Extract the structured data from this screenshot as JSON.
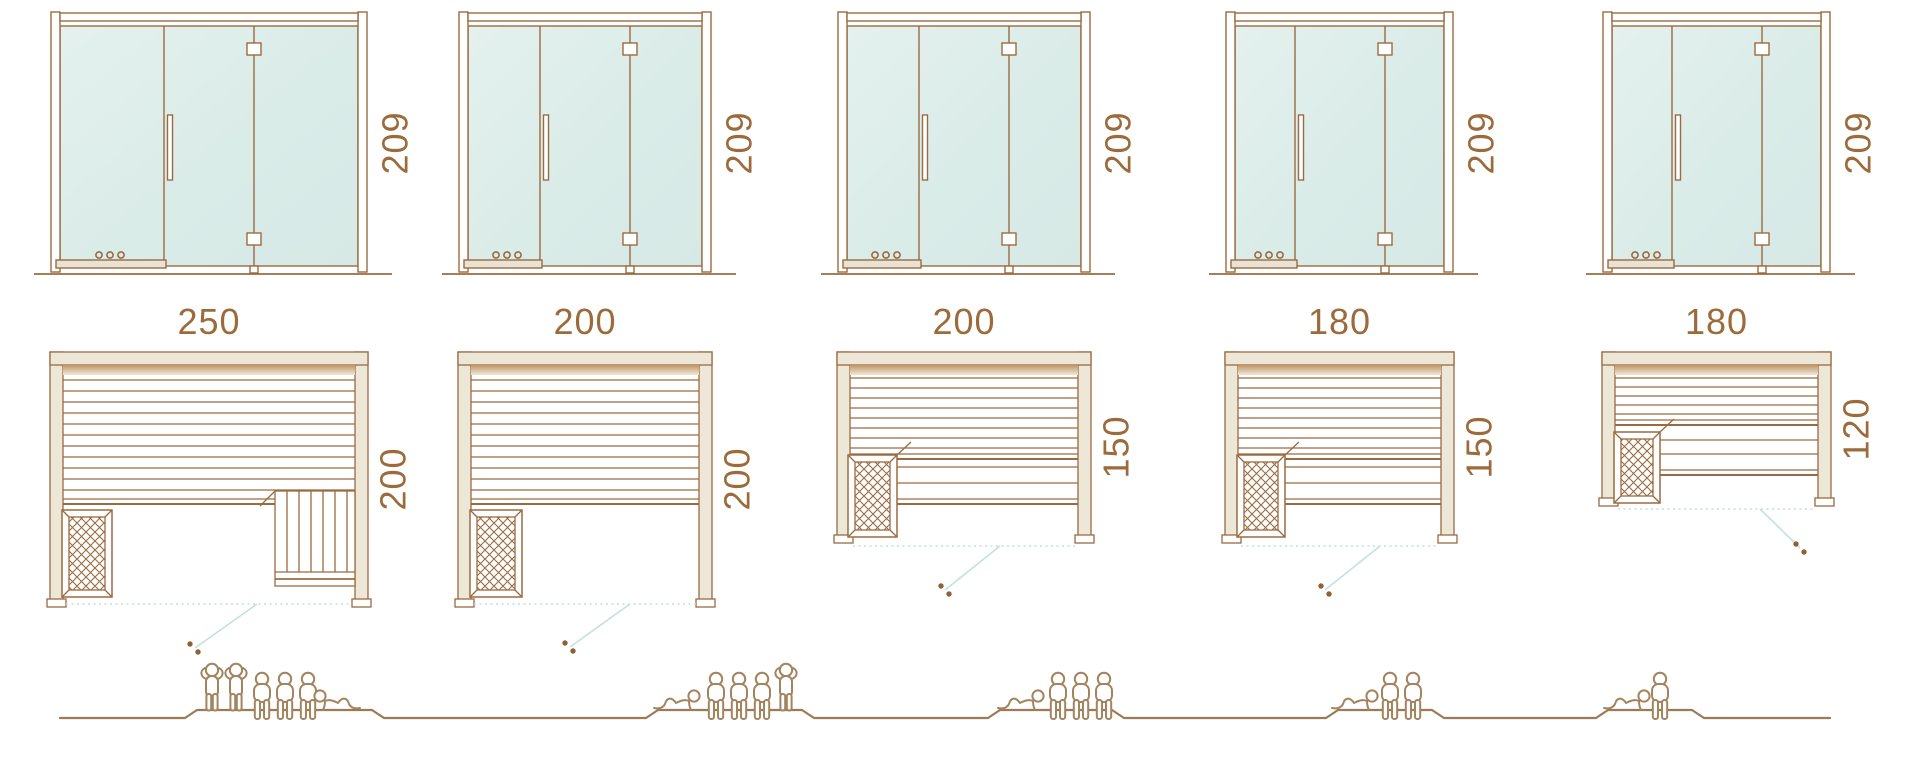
{
  "diagram_title": "sauna-cabin-size-comparison",
  "palette": {
    "line_brown": "#9a6b40",
    "dim_text": "#9c6b3b",
    "glass_mint": "#ddecea",
    "wall_beige": "#ece7d6",
    "teal_accent": "#bfe0db",
    "people_outline": "#a3845f"
  },
  "units": [
    {
      "height": "209",
      "width": "250",
      "depth": "200",
      "capacity": {
        "standing": 2,
        "sitting": 3,
        "lying": 1,
        "total": 6
      }
    },
    {
      "height": "209",
      "width": "200",
      "depth": "200",
      "capacity": {
        "standing": 1,
        "sitting": 3,
        "lying": 1,
        "total": 5
      }
    },
    {
      "height": "209",
      "width": "200",
      "depth": "150",
      "capacity": {
        "standing": 0,
        "sitting": 3,
        "lying": 1,
        "total": 4
      }
    },
    {
      "height": "209",
      "width": "180",
      "depth": "150",
      "capacity": {
        "standing": 0,
        "sitting": 2,
        "lying": 1,
        "total": 3
      }
    },
    {
      "height": "209",
      "width": "180",
      "depth": "120",
      "capacity": {
        "standing": 0,
        "sitting": 1,
        "lying": 1,
        "total": 2
      }
    }
  ]
}
